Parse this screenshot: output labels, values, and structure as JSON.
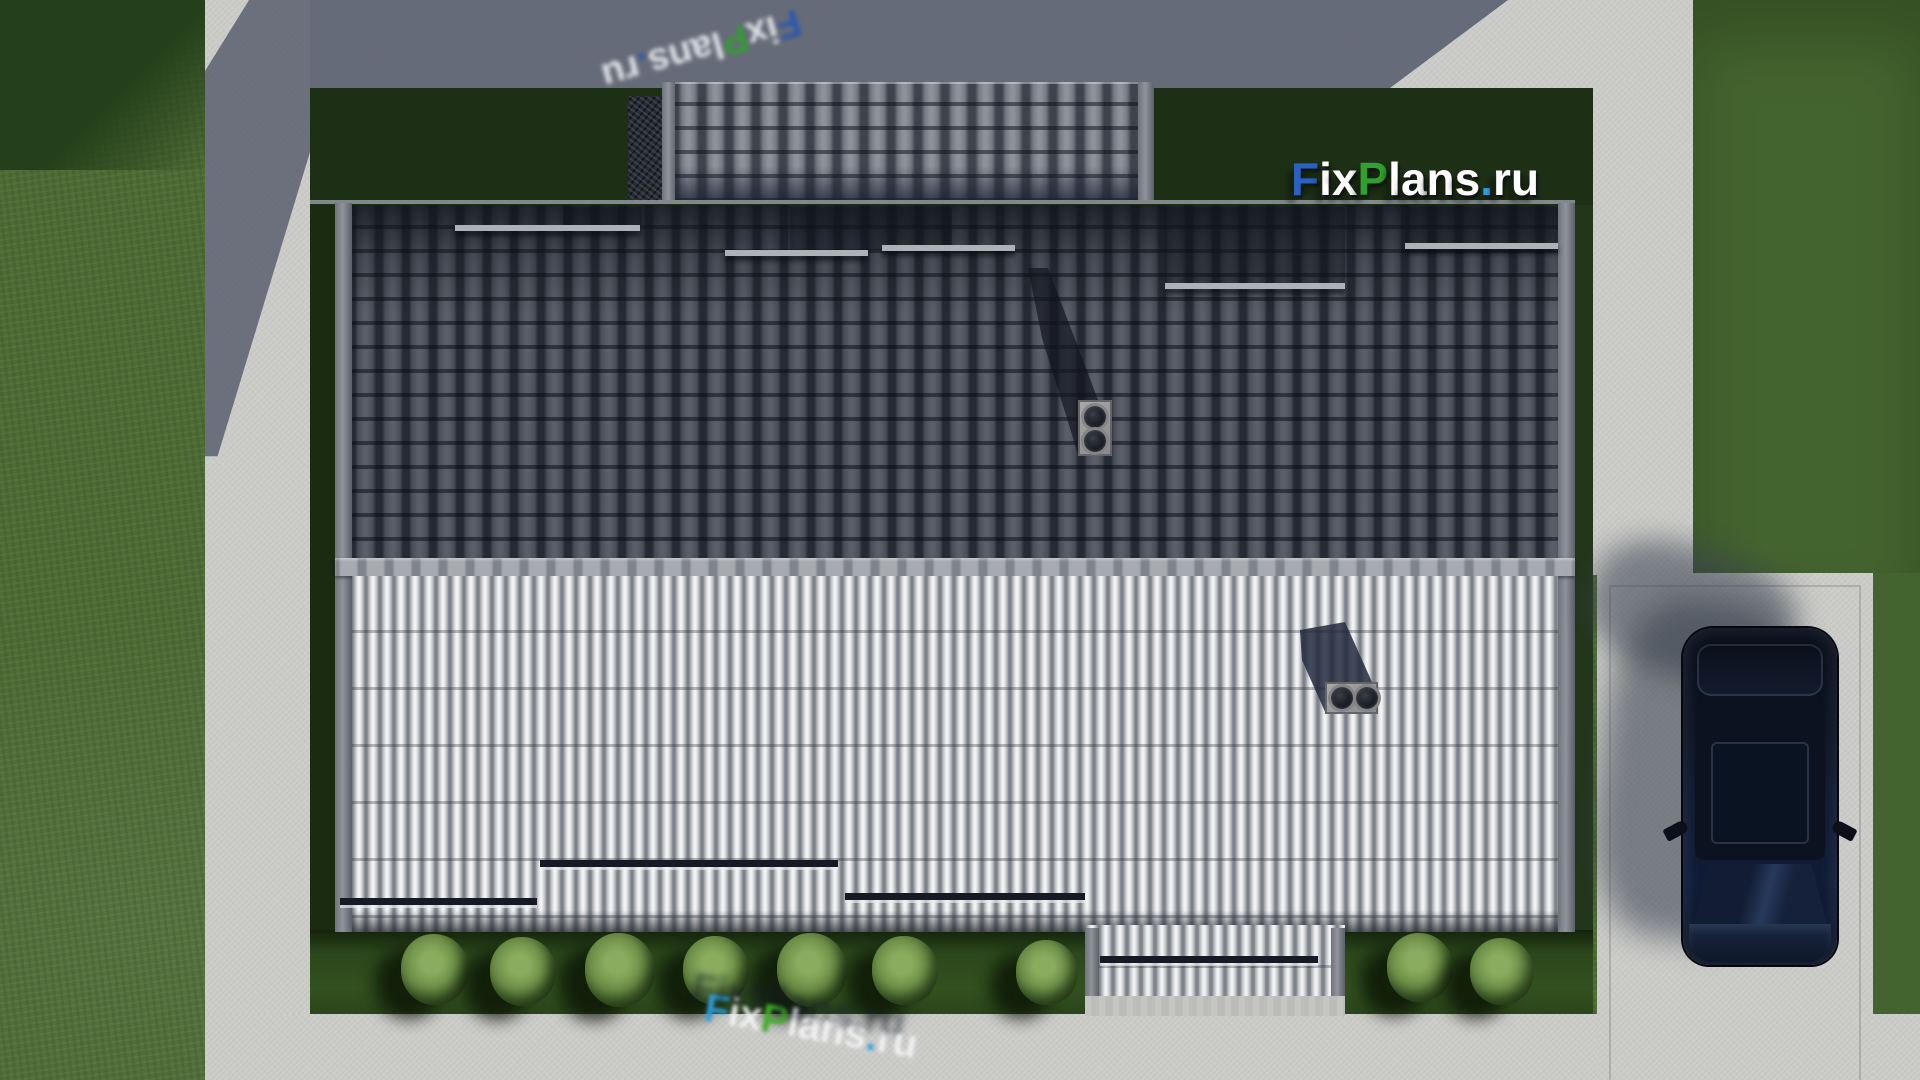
{
  "image_type": "3d architectural render, top (bird's-eye) view of a house roof",
  "watermark": {
    "site_text": "FixPlans.ru",
    "letters_main": [
      {
        "ch": "F",
        "color": "#2a62c4"
      },
      {
        "ch": "i",
        "color": "#ffffff"
      },
      {
        "ch": "x",
        "color": "#ffffff"
      },
      {
        "ch": "P",
        "color": "#2fa12c"
      },
      {
        "ch": "l",
        "color": "#ffffff"
      },
      {
        "ch": "a",
        "color": "#ffffff"
      },
      {
        "ch": "n",
        "color": "#ffffff"
      },
      {
        "ch": "s",
        "color": "#ffffff"
      },
      {
        "ch": ".",
        "color": "#29a3ee"
      },
      {
        "ch": "r",
        "color": "#ffffff"
      },
      {
        "ch": "u",
        "color": "#ffffff"
      }
    ],
    "letters_top": [
      {
        "ch": "F",
        "color": "#2456b4"
      },
      {
        "ch": "i",
        "color": "#e9ecef"
      },
      {
        "ch": "x",
        "color": "#e9ecef"
      },
      {
        "ch": "P",
        "color": "#2fa12c"
      },
      {
        "ch": "l",
        "color": "#e9ecef"
      },
      {
        "ch": "a",
        "color": "#e9ecef"
      },
      {
        "ch": "n",
        "color": "#e9ecef"
      },
      {
        "ch": "s",
        "color": "#e9ecef"
      },
      {
        "ch": ".",
        "color": "#2456b4"
      },
      {
        "ch": "r",
        "color": "#e9ecef"
      },
      {
        "ch": "u",
        "color": "#e9ecef"
      }
    ],
    "letters_bottom": [
      {
        "ch": "F",
        "color": "#2f9fe0"
      },
      {
        "ch": "i",
        "color": "#f2f3f4"
      },
      {
        "ch": "x",
        "color": "#f2f3f4"
      },
      {
        "ch": "P",
        "color": "#3fae27"
      },
      {
        "ch": "l",
        "color": "#f2f3f4"
      },
      {
        "ch": "a",
        "color": "#f2f3f4"
      },
      {
        "ch": "n",
        "color": "#f2f3f4"
      },
      {
        "ch": "s",
        "color": "#f2f3f4"
      },
      {
        "ch": ".",
        "color": "#2f9fe0"
      },
      {
        "ch": "r",
        "color": "#f2f3f4"
      },
      {
        "ch": "u",
        "color": "#f2f3f4"
      }
    ]
  },
  "scene": {
    "objects": [
      "gable roof house seen from directly above",
      "shaded north roof slope with dark barrel tiles",
      "sunlit south roof slope with light ribbed tiles",
      "garage roof section at top with stone chimney wall",
      "two roof vent chimneys with double round flues",
      "porch roof extension at bottom center",
      "row of trimmed shrubs along south wall",
      "dark navy SUV parked on concrete pad at right",
      "concrete walkways on left, top, right and bottom",
      "lawn with cast building shadows"
    ],
    "colors": {
      "grass": "#4d6b35",
      "grass_shadow": "#1d2f15",
      "concrete": "#cbcbc8",
      "concrete_shadow": "#5b6070",
      "roof_dark": "#494d58",
      "roof_light": "#c6c8cb",
      "ridge": "#9fa2a7",
      "car_body": "#0d1424",
      "brand_blue": "#2a62c4",
      "brand_green": "#2fa12c",
      "brand_lightblue": "#29a3ee"
    },
    "bushes": [
      {
        "x": 435,
        "y": 968,
        "s": 68
      },
      {
        "x": 523,
        "y": 970,
        "s": 66
      },
      {
        "x": 620,
        "y": 968,
        "s": 70
      },
      {
        "x": 716,
        "y": 969,
        "s": 66
      },
      {
        "x": 812,
        "y": 968,
        "s": 70
      },
      {
        "x": 905,
        "y": 969,
        "s": 66
      },
      {
        "x": 1047,
        "y": 971,
        "s": 62
      },
      {
        "x": 1420,
        "y": 966,
        "s": 66
      },
      {
        "x": 1502,
        "y": 970,
        "s": 64
      }
    ]
  }
}
